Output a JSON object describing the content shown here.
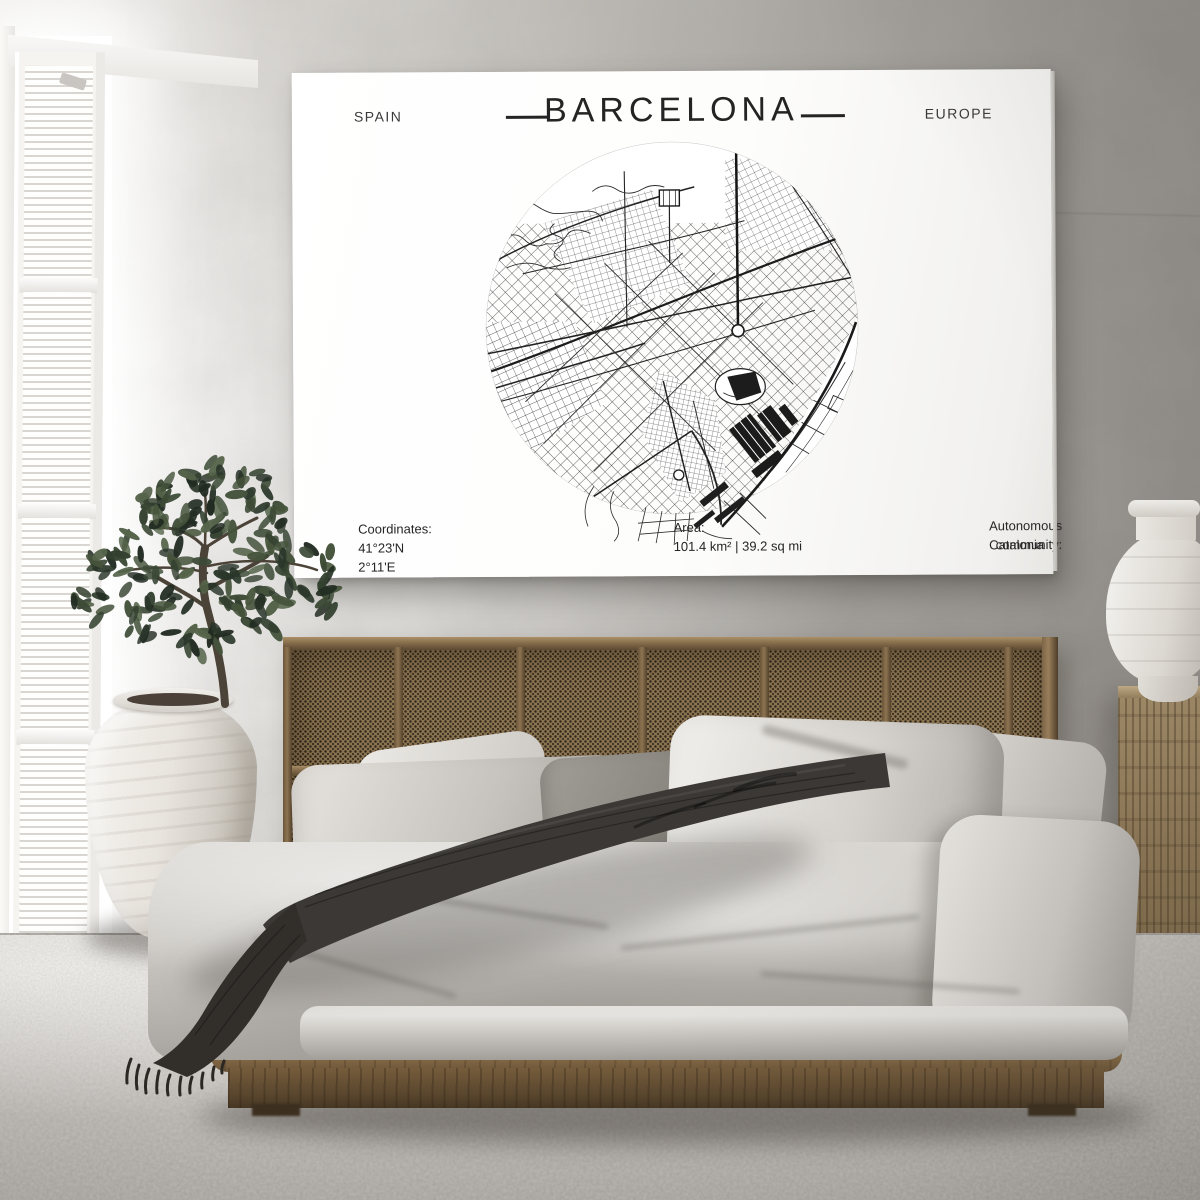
{
  "poster": {
    "country_label": "SPAIN",
    "title": "BARCELONA",
    "continent_label": "EUROPE",
    "footer": {
      "coordinates_label": "Coordinates:",
      "coordinates_value": "41°23'N 2°11'E",
      "area_label": "Area:",
      "area_value": "101.4 km² | 39.2 sq mi",
      "community_label": "Autonomous community:",
      "community_value": "Catalonia"
    }
  },
  "palette": {
    "wall_light": "#f2f0ed",
    "wall_dark": "#8a8681",
    "poster_paper": "#fdfdfc",
    "map_ink": "#262626",
    "headboard_cane": "#8a7351",
    "bed_wood": "#876c48",
    "bedding_light": "#ccc9c4",
    "pillow_dark": "#85817b",
    "throw_dark": "#3a3733",
    "carpet": "#c5c1bc",
    "urn_white": "#e8e4de",
    "plant_greens": [
      "#33402f",
      "#3c4a36",
      "#2a362a",
      "#46543c",
      "#55644a",
      "#222c22"
    ]
  }
}
